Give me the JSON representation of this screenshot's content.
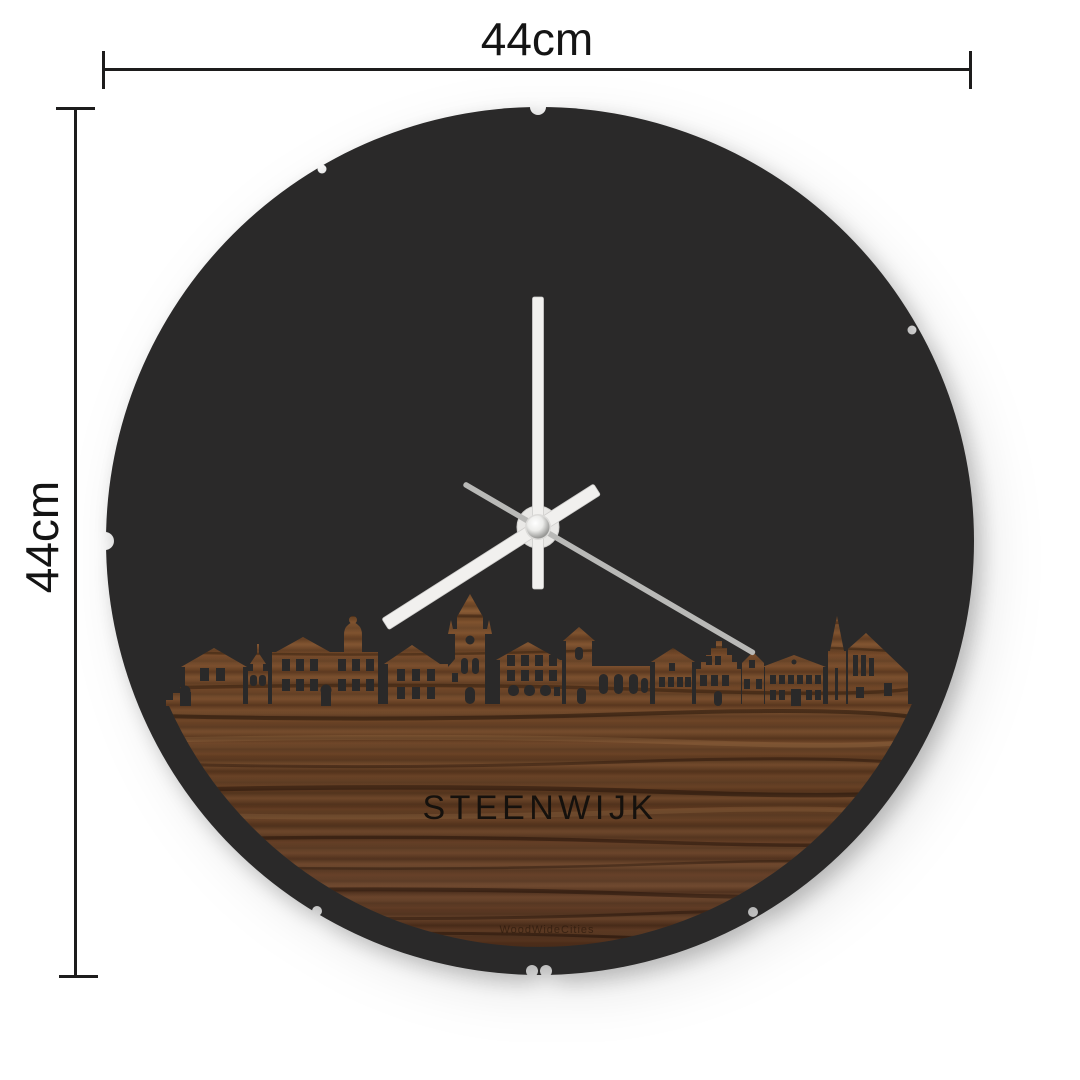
{
  "dimensions": {
    "width_label": "44cm",
    "height_label": "44cm"
  },
  "clock": {
    "city_label": "STEENWIJK",
    "brand_watermark": "WoodWideCities",
    "hands": {
      "minute_angle_deg": 0,
      "hour_angle_deg": 237.5,
      "second_angle_deg": 120.3
    }
  },
  "colors": {
    "background": "#ffffff",
    "dimension_lines": "#1d1c1c",
    "clock_face": "#2a2929",
    "wood_light": "#86572f",
    "wood_mid": "#6d4426",
    "wood_dark": "#4e2d19",
    "hand_white": "#f1f0ee",
    "hand_second": "#b9b9b7",
    "hub_metal": "#9d9d9b"
  }
}
